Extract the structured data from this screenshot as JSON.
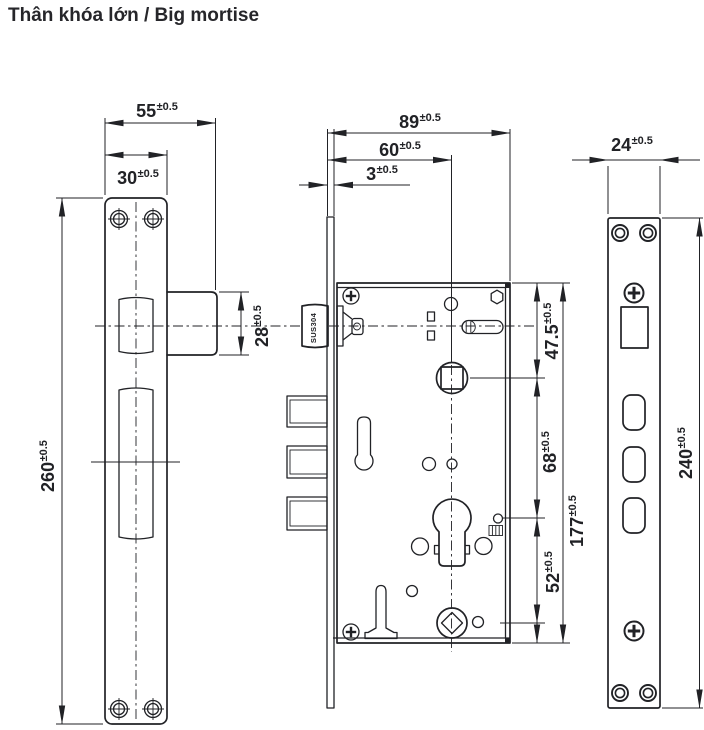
{
  "title": "Thân khóa lớn  / Big mortise",
  "material_label": "SUS304",
  "colors": {
    "line": "#212226",
    "background": "#ffffff"
  },
  "dims": {
    "overall_width": {
      "value": "55",
      "tol": "±0.5"
    },
    "plate_width": {
      "value": "30",
      "tol": "±0.5"
    },
    "plate_height": {
      "value": "260",
      "tol": "±0.5"
    },
    "latch_height": {
      "value": "28",
      "tol": "±0.5"
    },
    "body_depth": {
      "value": "89",
      "tol": "±0.5"
    },
    "backset": {
      "value": "60",
      "tol": "±0.5"
    },
    "faceplate_thickness": {
      "value": "3",
      "tol": "±0.5"
    },
    "top_to_spindle": {
      "value": "47.5",
      "tol": "±0.5"
    },
    "spindle_to_cylinder": {
      "value": "68",
      "tol": "±0.5"
    },
    "body_height": {
      "value": "177",
      "tol": "±0.5"
    },
    "cylinder_to_follower": {
      "value": "52",
      "tol": "±0.5"
    },
    "strike_width": {
      "value": "24",
      "tol": "±0.5"
    },
    "strike_height": {
      "value": "240",
      "tol": "±0.5"
    }
  }
}
